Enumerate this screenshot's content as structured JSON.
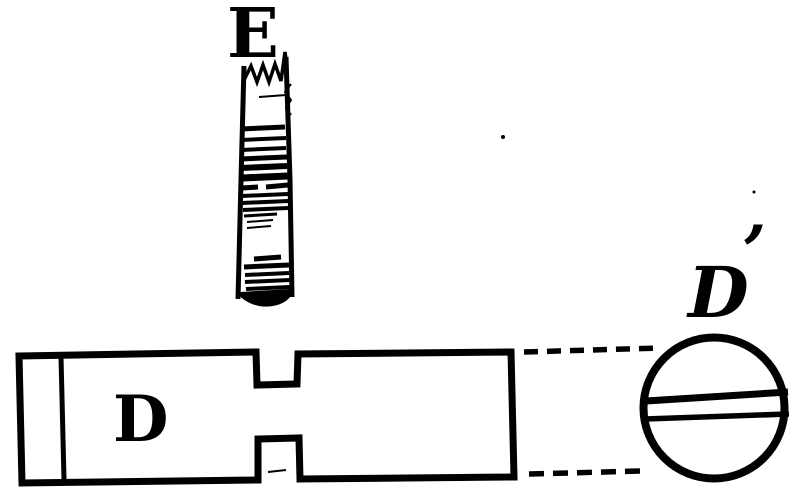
{
  "colors": {
    "ink": "#000000",
    "paper": "#ffffff"
  },
  "labels": {
    "screw": "E",
    "shaft": "D",
    "end_view": "D",
    "end_view_prime": "’"
  }
}
